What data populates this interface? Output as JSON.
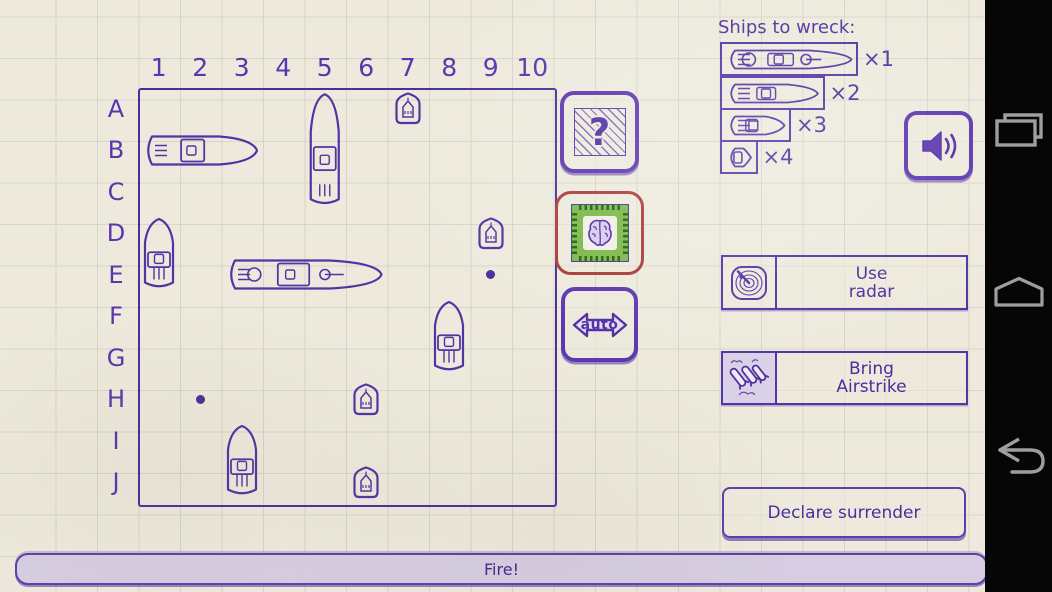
{
  "colors": {
    "ink": "#5233a4",
    "grid_border": "#4b2e9c",
    "turn_highlight_red": "#a93c3c",
    "chip_green": "#7cb84a",
    "paper": "#edeadd",
    "button_fill": "#d6cde2",
    "nav_icon_gray": "#9e9e9e"
  },
  "grid": {
    "columns": [
      "1",
      "2",
      "3",
      "4",
      "5",
      "6",
      "7",
      "8",
      "9",
      "10"
    ],
    "rows": [
      "A",
      "B",
      "C",
      "D",
      "E",
      "F",
      "G",
      "H",
      "I",
      "J"
    ]
  },
  "board": {
    "ships": [
      {
        "size": 3,
        "orientation": "h",
        "row": 1,
        "col": 0,
        "cells": "B1-B3"
      },
      {
        "size": 3,
        "orientation": "v",
        "row": 0,
        "col": 4,
        "cells": "A5-C5"
      },
      {
        "size": 4,
        "orientation": "h",
        "row": 4,
        "col": 2,
        "cells": "E3-E6"
      },
      {
        "size": 2,
        "orientation": "v",
        "row": 3,
        "col": 0,
        "cells": "D1-E1"
      },
      {
        "size": 2,
        "orientation": "v",
        "row": 5,
        "col": 7,
        "cells": "F8-G8"
      },
      {
        "size": 2,
        "orientation": "v",
        "row": 8,
        "col": 2,
        "cells": "I3-J3"
      },
      {
        "size": 1,
        "orientation": "v",
        "row": 0,
        "col": 6,
        "cells": "A7"
      },
      {
        "size": 1,
        "orientation": "v",
        "row": 3,
        "col": 8,
        "cells": "D9"
      },
      {
        "size": 1,
        "orientation": "v",
        "row": 7,
        "col": 5,
        "cells": "H6"
      },
      {
        "size": 1,
        "orientation": "v",
        "row": 9,
        "col": 5,
        "cells": "J6"
      }
    ],
    "misses": [
      {
        "row": 7,
        "col": 1,
        "cell": "H2"
      },
      {
        "row": 4,
        "col": 8,
        "cell": "E9"
      }
    ]
  },
  "fleet_panel": {
    "title": "Ships to wreck:",
    "items": [
      {
        "size": 4,
        "count_label": "×1"
      },
      {
        "size": 3,
        "count_label": "×2"
      },
      {
        "size": 2,
        "count_label": "×3"
      },
      {
        "size": 1,
        "count_label": "×4"
      }
    ]
  },
  "buttons": {
    "mystery_glyph": "?",
    "auto_label": "auto",
    "use_radar_line1": "Use",
    "use_radar_line2": "radar",
    "airstrike_line1": "Bring",
    "airstrike_line2": "Airstrike",
    "surrender_label": "Declare surrender",
    "fire_label": "Fire!"
  }
}
